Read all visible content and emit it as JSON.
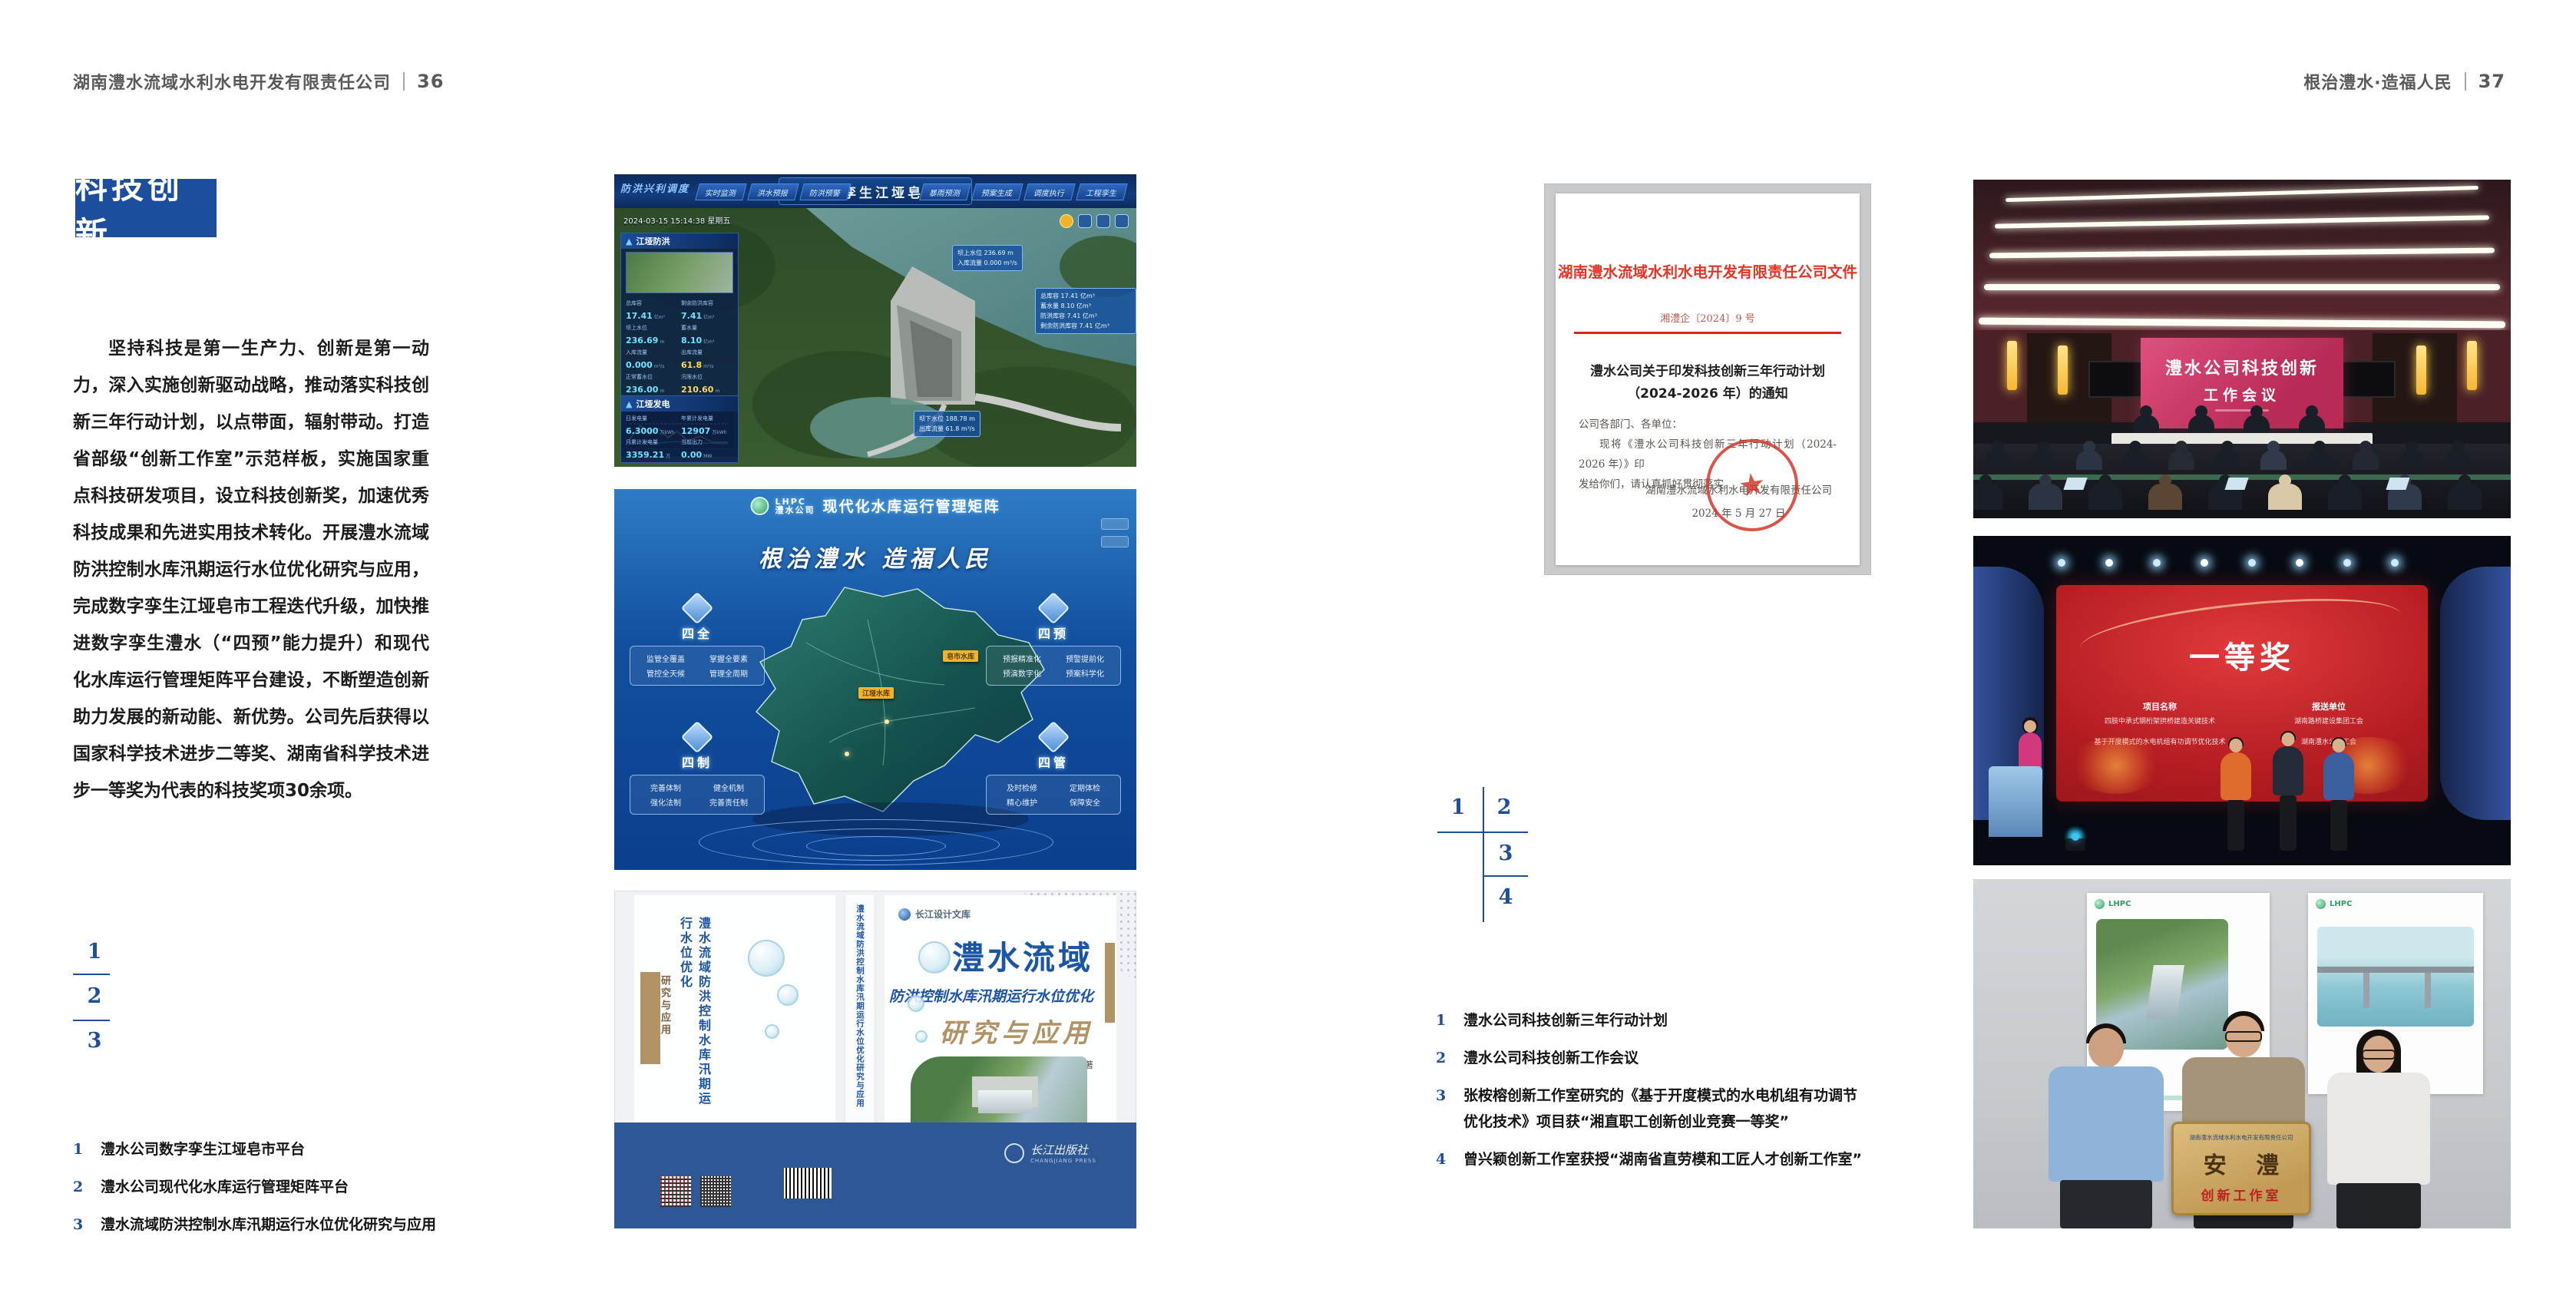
{
  "colors": {
    "accent_blue": "#1d4e9e",
    "index_blue": "#1f4e9c",
    "doc_red": "#e63324",
    "screen_pink": "#cf3f6e",
    "award_red": "#c0181d",
    "cover_blue": "#1d55a5",
    "cover_tan": "#b29366",
    "band_blue": "#2d5795"
  },
  "page_left": {
    "header": {
      "company": "湖南澧水流域水利水电开发有限责任公司",
      "page_no": "36"
    },
    "badge": "科技创新",
    "body": "坚持科技是第一生产力、创新是第一动力，深入实施创新驱动战略，推动落实科技创新三年行动计划，以点带面，辐射带动。打造省部级“创新工作室”示范样板，实施国家重点科技研发项目，设立科技创新奖，加速优秀科技成果和先进实用技术转化。开展澧水流域防洪控制水库汛期运行水位优化研究与应用，完成数字孪生江垭皂市工程迭代升级，加快推进数字孪生澧水（“四预”能力提升）和现代化水库运行管理矩阵平台建设，不断塑造创新助力发展的新动能、新优势。公司先后获得以国家科学技术进步二等奖、湖南省科学技术进步一等奖为代表的科技奖项30余项。",
    "figure_index": [
      "1",
      "2",
      "3"
    ],
    "captions": [
      {
        "no": "1",
        "text": "澧水公司数字孪生江垭皂市平台"
      },
      {
        "no": "2",
        "text": "澧水公司现代化水库运行管理矩阵平台"
      },
      {
        "no": "3",
        "text": "澧水流域防洪控制水库汛期运行水位优化研究与应用"
      }
    ],
    "fig1": {
      "corner_title": "防洪兴利调度",
      "title": "数字孪生江垭皂市",
      "tabs_left": [
        "实时监测",
        "洪水预报",
        "防洪预警"
      ],
      "tabs_right": [
        "暴雨预测",
        "预案生成",
        "调度执行",
        "工程孪生"
      ],
      "datetime": "2024-03-15 15:14:38 星期五",
      "panel1_title": "江垭防洪",
      "stats1": [
        {
          "l": "总库容",
          "v": "17.41",
          "u": "亿m³"
        },
        {
          "l": "剩余防洪库容",
          "v": "7.41",
          "u": "亿m³"
        },
        {
          "l": "坝上水位",
          "v": "236.69",
          "u": "m"
        },
        {
          "l": "蓄水量",
          "v": "8.10",
          "u": "亿m³"
        },
        {
          "l": "入库流量",
          "v": "0.000",
          "u": "m³/s"
        },
        {
          "l": "出库流量",
          "v": "61.8",
          "u": "m³/s"
        },
        {
          "l": "正常蓄水位",
          "v": "236.00",
          "u": "m"
        },
        {
          "l": "汛限水位",
          "v": "210.60",
          "u": "m"
        }
      ],
      "chart_legend": [
        "坝上水位",
        "入库流量",
        "出库流量"
      ],
      "panel2_title": "江垭发电",
      "stats2": [
        {
          "l": "日发电量",
          "v": "6.3000",
          "u": "万kWh"
        },
        {
          "l": "年累计发电量",
          "v": "12907",
          "u": "万kWh"
        },
        {
          "l": "月累计发电量",
          "v": "3359.21",
          "u": "万kWh"
        },
        {
          "l": "当前出力",
          "v": "0.00",
          "u": "MW"
        },
        {
          "l": "发电流量",
          "v": "0.00",
          "u": "m³/s"
        },
        {
          "l": "弃水流量",
          "v": "0.00",
          "u": "m³/s"
        }
      ],
      "tag_dam_top": {
        "l1": "坝上水位 236.69 m",
        "l2": "入库流量 0.000 m³/s"
      },
      "tag_info": [
        "总库容 17.41 亿m³",
        "蓄水量 8.10 亿m³",
        "防洪库容 7.41 亿m³",
        "剩余防洪库容 7.41 亿m³"
      ],
      "tag_dam_bottom": {
        "l1": "坝下水位 188.78 m",
        "l2": "出库流量 61.8 m³/s"
      }
    },
    "fig2": {
      "logo": "LHPC 澧水公司",
      "title": "现代化水库运行管理矩阵",
      "slogan": "根治澧水 造福人民",
      "groups": [
        {
          "name": "四全",
          "items": [
            "监管全覆盖",
            "掌握全要素",
            "管控全天候",
            "管理全周期"
          ]
        },
        {
          "name": "四预",
          "items": [
            "预报精准化",
            "预警提前化",
            "预演数字化",
            "预案科学化"
          ]
        },
        {
          "name": "四制",
          "items": [
            "完善体制",
            "健全机制",
            "强化法制",
            "完善责任制"
          ]
        },
        {
          "name": "四管",
          "items": [
            "及时检修",
            "定期体检",
            "精心维护",
            "保障安全"
          ]
        }
      ],
      "map_tags": [
        "皂市水库",
        "江垭水库"
      ]
    },
    "fig3": {
      "library": "长江设计文库",
      "title_main": "澧水流域",
      "title_sub": "防洪控制水库汛期运行水位优化",
      "title_accent": "研究与应用",
      "authors": "洪兴骏 沈坤民 鲁军 刘世军 等著",
      "spine": "澧水流域防洪控制水库汛期运行水位优化研究与应用",
      "back_title": "澧水流域防洪控制水库汛期运行水位优化",
      "back_accent": "研究与应用",
      "publisher": "长江出版社",
      "publisher_en": "CHANGJIANG PRESS"
    }
  },
  "page_right": {
    "header": {
      "slogan": "根治澧水·造福人民",
      "page_no": "37"
    },
    "document": {
      "header": "湖南澧水流域水利水电开发有限责任公司文件",
      "doc_no": "湘澧企〔2024〕9 号",
      "title_l1": "澧水公司关于印发科技创新三年行动计划",
      "title_l2": "（2024-2026 年）的通知",
      "salutation": "公司各部门、各单位：",
      "body_l1": "现将《澧水公司科技创新三年行动计划（2024-2026 年）》印",
      "body_l2": "发给你们，请认真抓好贯彻落实。",
      "signer": "湖南澧水流域水利水电开发有限责任公司",
      "date": "2024 年 5 月 27 日",
      "seal_star": "★"
    },
    "figure_index": [
      "1",
      "2",
      "3",
      "4"
    ],
    "captions": [
      {
        "no": "1",
        "text": "澧水公司科技创新三年行动计划"
      },
      {
        "no": "2",
        "text": "澧水公司科技创新工作会议"
      },
      {
        "no": "3",
        "line1": "张桉榕创新工作室研究的《基于开度模式的水电机组有功调节",
        "line2": "优化技术》项目获“湘直职工创新创业竞赛一等奖”"
      },
      {
        "no": "4",
        "text": "曾兴颖创新工作室获授“湖南省直劳模和工匠人才创新工作室”"
      }
    ],
    "photo_meeting": {
      "screen_l1": "澧水公司科技创新",
      "screen_l2": "工作会议"
    },
    "photo_award": {
      "title": "一等奖",
      "col1_header": "项目名称",
      "col1_items": [
        "四肢中承式钢桁架拱桥建造关键技术",
        "基于开度模式的水电机组有功调节优化技术"
      ],
      "col2_header": "报送单位",
      "col2_items": [
        "湖南路桥建设集团工会",
        "湖南澧水公司工会"
      ]
    },
    "photo_plaque": {
      "plaque_header": "湖南澧水流域水利水电开发有限责任公司",
      "plaque_title": "安 澧",
      "plaque_subtitle": "创新工作室",
      "poster_logo": "LHPC"
    }
  }
}
